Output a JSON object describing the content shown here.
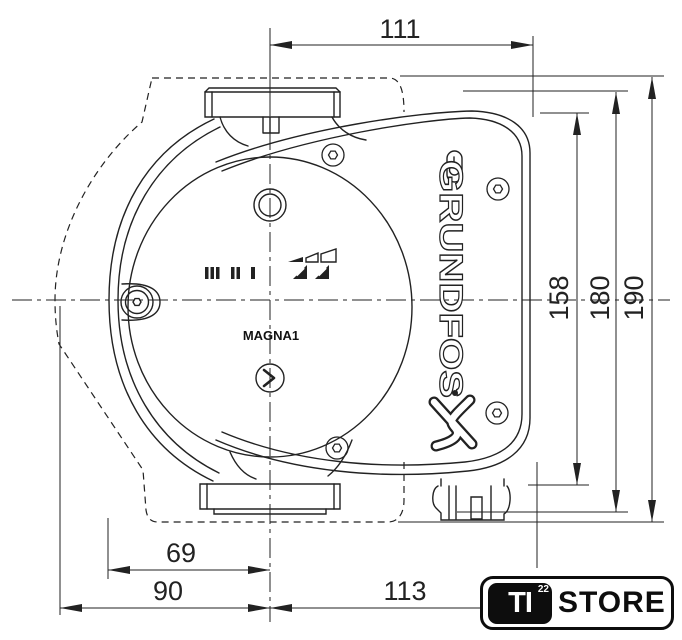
{
  "drawing": {
    "brand": "GRUNDFOS",
    "model": "MAGNA1",
    "view": "front dimensional drawing"
  },
  "dims": {
    "w111": "111",
    "h158": "158",
    "h180": "180",
    "h190": "190",
    "w69": "69",
    "w90": "90",
    "w113": "113"
  },
  "logo": {
    "prefix": "TI",
    "sup": "22",
    "name": "STORE"
  },
  "icons": {
    "screws": "torx-screw-icon",
    "vent": "vent-plug-icon",
    "drain": "drain-plug-icon",
    "speed_bars": "speed-setting-bars-icon",
    "ramp": "speed-ramp-icon",
    "buttons": "speed-select-button-icon"
  },
  "colors": {
    "line": "#222222",
    "background": "#ffffff",
    "logo_black": "#0d0d0d"
  }
}
